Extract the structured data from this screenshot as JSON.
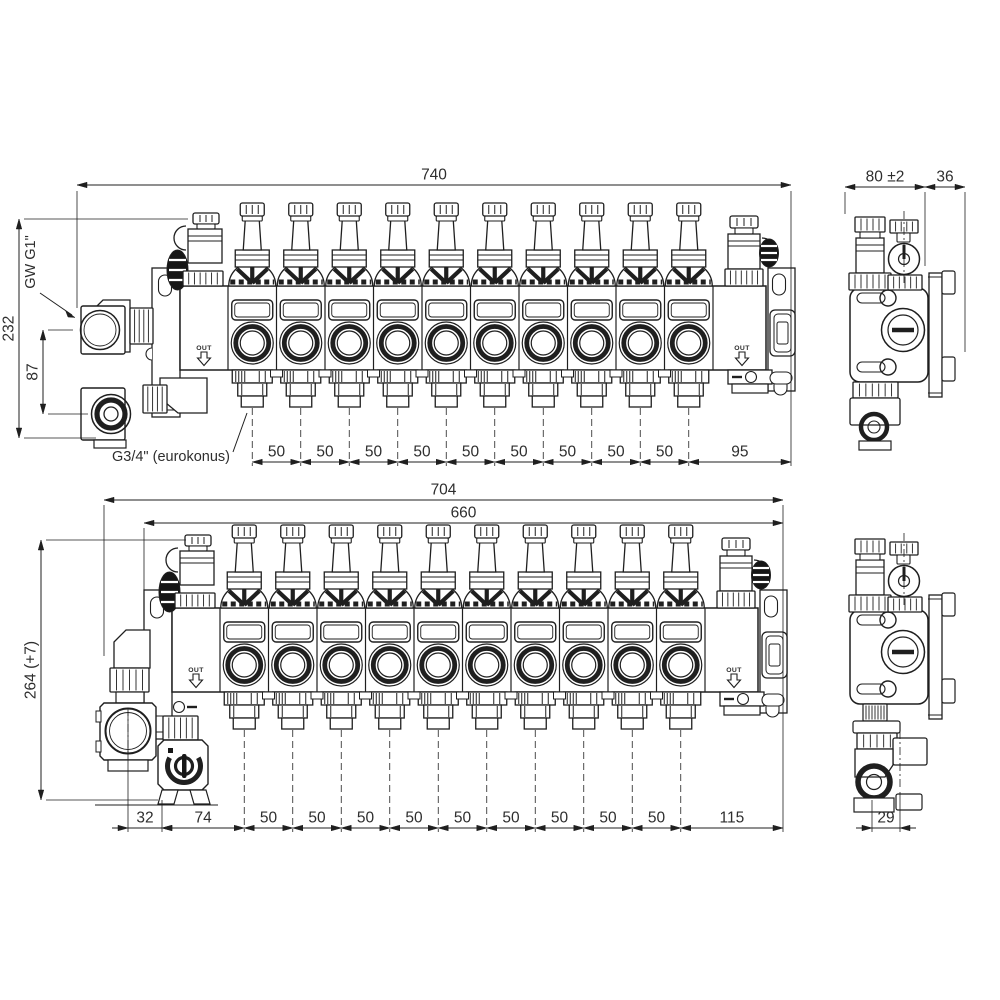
{
  "drawing": {
    "background": "#ffffff",
    "line_color": "#1f1f1f",
    "views": {
      "front_top": {
        "circuits": 10,
        "out_label": "OUT",
        "annotations": {
          "supply_thread": "GW G1\"",
          "outlet_thread": "G3/4\" (eurokonus)"
        },
        "dimensions": {
          "overall_width": "740",
          "overall_height": "232",
          "port_offset": "87",
          "outlet_spacings": [
            "50",
            "50",
            "50",
            "50",
            "50",
            "50",
            "50",
            "50",
            "50"
          ],
          "right_end_offset": "95"
        }
      },
      "side_top": {
        "dimensions": {
          "body_depth": "80 ±2",
          "bracket_depth": "36"
        }
      },
      "front_bottom": {
        "circuits": 10,
        "out_label": "OUT",
        "dimensions": {
          "overall_width": "704",
          "mounting_width": "660",
          "overall_height": "264 (+7)",
          "pump_offset": "32",
          "valve_to_first_outlet": "74",
          "outlet_spacings": [
            "50",
            "50",
            "50",
            "50",
            "50",
            "50",
            "50",
            "50",
            "50"
          ],
          "right_end_offset": "115"
        }
      },
      "side_bottom": {
        "dimensions": {
          "elbow_offset": "29"
        }
      }
    }
  }
}
